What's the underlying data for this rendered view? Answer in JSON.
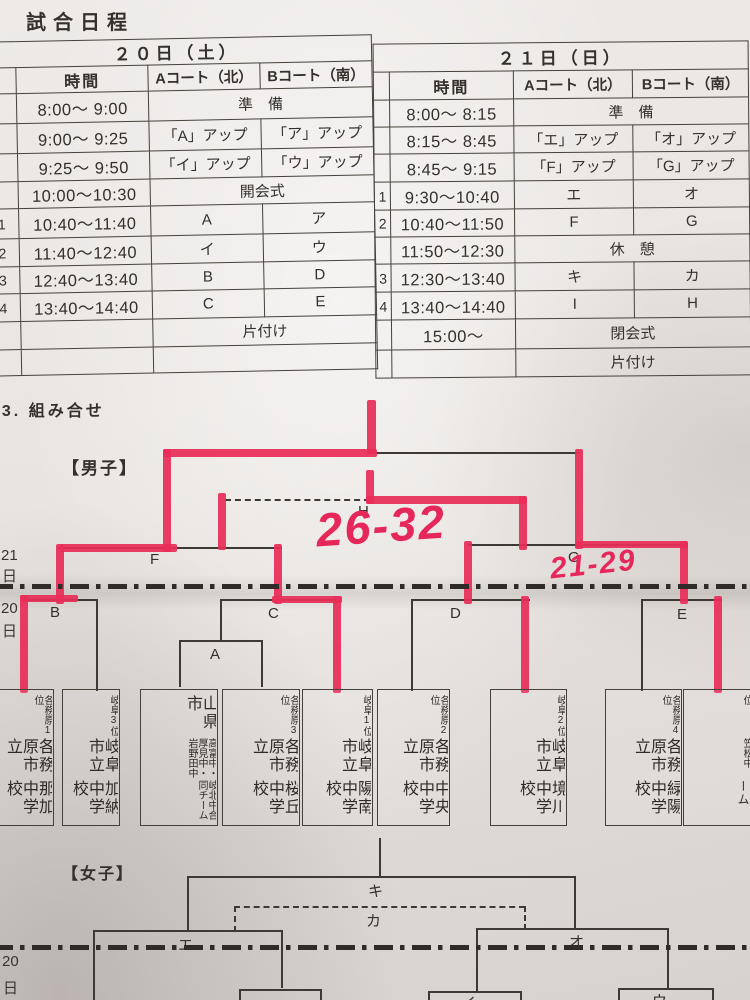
{
  "title": "試合日程",
  "section_heading": "13. 組み合せ",
  "mens_label": "【男子】",
  "womens_label": "【女子】",
  "tables": [
    {
      "day": "２０日（土）",
      "cols": [
        "時間",
        "Aコート（北）",
        "Bコート（南）"
      ],
      "rows": [
        [
          "",
          "8:00～ 9:00",
          "準　備",
          null
        ],
        [
          "",
          "9:00～ 9:25",
          "「A」アップ",
          "「ア」アップ"
        ],
        [
          "",
          "9:25～ 9:50",
          "「イ」アップ",
          "「ウ」アップ"
        ],
        [
          "",
          "10:00～10:30",
          "開会式",
          null
        ],
        [
          "1",
          "10:40～11:40",
          "A",
          "ア"
        ],
        [
          "2",
          "11:40～12:40",
          "イ",
          "ウ"
        ],
        [
          "3",
          "12:40～13:40",
          "B",
          "D"
        ],
        [
          "4",
          "13:40～14:40",
          "C",
          "E"
        ],
        [
          "",
          "",
          "片付け",
          null
        ],
        [
          "",
          "",
          "",
          null
        ]
      ]
    },
    {
      "day": "２１日（日）",
      "cols": [
        "時間",
        "Aコート（北）",
        "Bコート（南）"
      ],
      "rows": [
        [
          "",
          "8:00～ 8:15",
          "準　備",
          null
        ],
        [
          "",
          "8:15～ 8:45",
          "「エ」アップ",
          "「オ」アップ"
        ],
        [
          "",
          "8:45～ 9:15",
          "「F」アップ",
          "「G」アップ"
        ],
        [
          "1",
          "9:30～10:40",
          "エ",
          "オ"
        ],
        [
          "2",
          "10:40～11:50",
          "F",
          "G"
        ],
        [
          "",
          "11:50～12:30",
          "休　憩",
          null
        ],
        [
          "3",
          "12:30～13:40",
          "キ",
          "カ"
        ],
        [
          "4",
          "13:40～14:40",
          "I",
          "H"
        ],
        [
          "",
          "15:00～",
          "閉会式",
          null
        ],
        [
          "",
          "",
          "片付け",
          null
        ]
      ]
    }
  ],
  "match_labels": {
    "a": "A",
    "b": "B",
    "c": "C",
    "d": "D",
    "e": "E",
    "f": "F",
    "g": "G",
    "h": "H",
    "ki": "キ",
    "ka": "カ",
    "e_w": "エ",
    "o_w": "オ",
    "i_w": "イ",
    "u_w": "ウ"
  },
  "margin_days": {
    "top_day": "21",
    "top_day_kanji": "日",
    "mid_day": "20",
    "mid_day_kanji": "日",
    "bottom_day": "20",
    "bottom_day_kanji": "日"
  },
  "scores": {
    "final": "26-32",
    "right_semi": "21-29"
  },
  "marker_color": "#e82e58",
  "teams": [
    {
      "cols": [
        {
          "t": "各務原1位",
          "s": "s"
        },
        {
          "t": "各務原市立",
          "s": "l"
        },
        {
          "t": "那加中学校",
          "s": "l"
        }
      ]
    },
    {
      "cols": [
        {
          "t": "岐阜3位",
          "s": "s"
        },
        {
          "t": "岐阜市立",
          "s": "l"
        },
        {
          "t": "加納中学校",
          "s": "l"
        }
      ]
    },
    {
      "cols": [
        {
          "t": "山県市",
          "s": "l"
        },
        {
          "t": "高富中・厚見中・岩野田中",
          "s": "s"
        },
        {
          "t": "岐北中合同チーム",
          "s": "s"
        }
      ]
    },
    {
      "cols": [
        {
          "t": "各務原3位",
          "s": "s"
        },
        {
          "t": "各務原市立",
          "s": "l"
        },
        {
          "t": "桜丘中学校",
          "s": "l"
        }
      ]
    },
    {
      "cols": [
        {
          "t": "岐阜1位",
          "s": "s"
        },
        {
          "t": "岐阜市立",
          "s": "l"
        },
        {
          "t": "陽南中学校",
          "s": "l"
        }
      ]
    },
    {
      "cols": [
        {
          "t": "各務原2位",
          "s": "s"
        },
        {
          "t": "各務原市立",
          "s": "l"
        },
        {
          "t": "中央中学校",
          "s": "l"
        }
      ]
    },
    {
      "cols": [
        {
          "t": "岐阜2位",
          "s": "s"
        },
        {
          "t": "岐阜市立",
          "s": "l"
        },
        {
          "t": "境川中学校",
          "s": "l"
        }
      ]
    },
    {
      "cols": [
        {
          "t": "各務原4位",
          "s": "s"
        },
        {
          "t": "各務原市立",
          "s": "l"
        },
        {
          "t": "緑陽中学校",
          "s": "l"
        }
      ]
    },
    {
      "cols": [
        {
          "t": "羽島B1位",
          "s": "s"
        },
        {
          "t": "羽島中・笠松中",
          "s": "s"
        },
        {
          "t": "合同チーム",
          "s": "m"
        }
      ]
    }
  ]
}
